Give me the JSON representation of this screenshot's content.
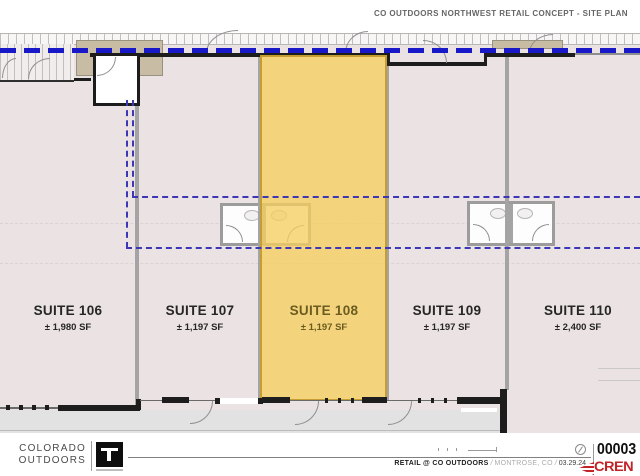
{
  "header": {
    "title": "CO OUTDOORS NORTHWEST RETAIL CONCEPT - SITE PLAN"
  },
  "plan": {
    "suites": [
      {
        "name": "SUITE 106",
        "area": "± 1,980 SF",
        "highlighted": false
      },
      {
        "name": "SUITE 107",
        "area": "± 1,197 SF",
        "highlighted": false
      },
      {
        "name": "SUITE 108",
        "area": "± 1,197 SF",
        "highlighted": true
      },
      {
        "name": "SUITE 109",
        "area": "± 1,197 SF",
        "highlighted": false
      },
      {
        "name": "SUITE 110",
        "area": "± 2,400 SF",
        "highlighted": false
      }
    ]
  },
  "footer": {
    "brand_line1": "COLORADO",
    "brand_line2": "OUTDOORS",
    "project": "RETAIL @ CO OUTDOORS",
    "location": "MONTROSE, CO",
    "date": "03.29.24",
    "separator": "/",
    "sheet_number": "00003",
    "cren_label": "CREN"
  },
  "colors": {
    "suite_highlight": "#f6ce60",
    "property_line_blue": "#1818c8",
    "lease_line_blue": "#3d37b5",
    "cren_red": "#c22428",
    "plan_fill": "#ebe3e3"
  }
}
